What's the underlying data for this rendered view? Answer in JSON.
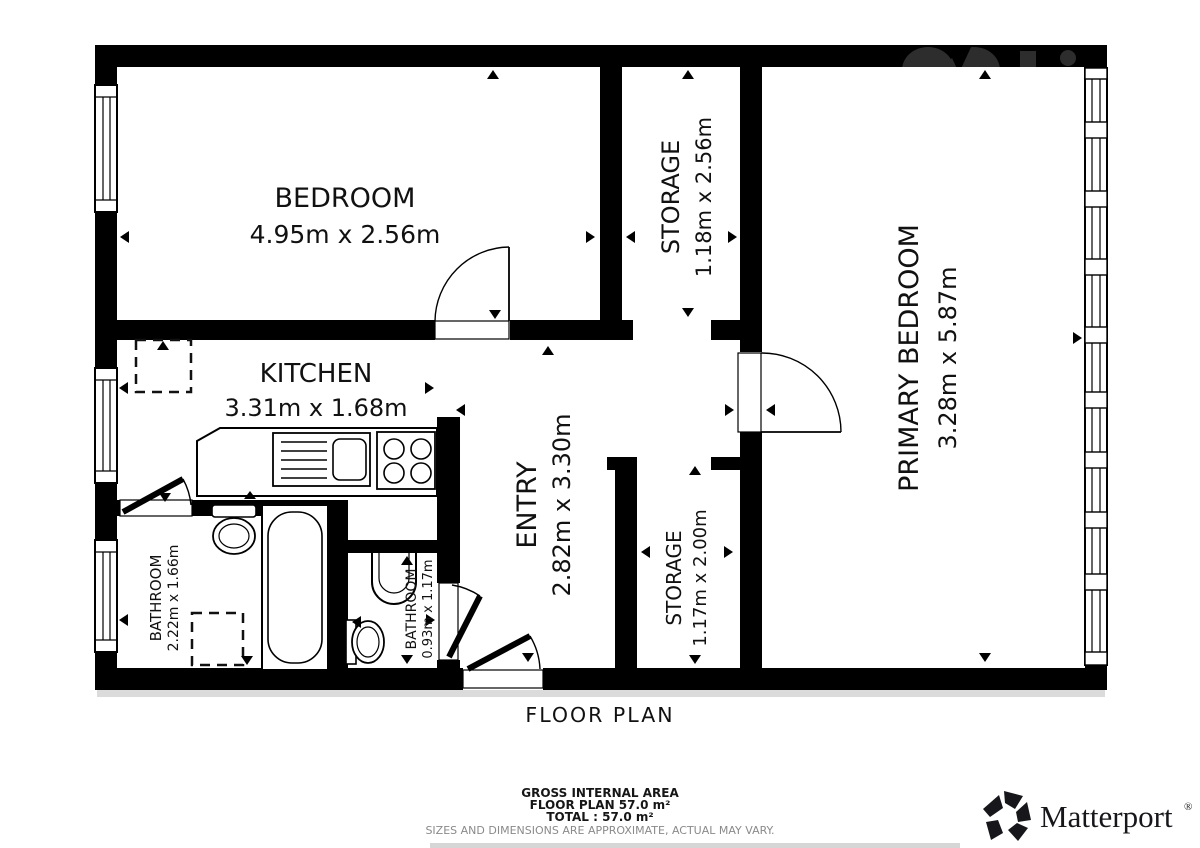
{
  "title": "FLOOR PLAN",
  "rooms": [
    {
      "name": "BEDROOM",
      "dims": "4.95m x 2.56m"
    },
    {
      "name": "STORAGE",
      "dims": "1.18m x 2.56m"
    },
    {
      "name": "PRIMARY BEDROOM",
      "dims": "3.28m x 5.87m"
    },
    {
      "name": "KITCHEN",
      "dims": "3.31m x 1.68m"
    },
    {
      "name": "ENTRY",
      "dims": "2.82m x 3.30m"
    },
    {
      "name": "STORAGE",
      "dims": "1.17m x 2.00m"
    },
    {
      "name": "BATHROOM",
      "dims": "2.22m x 1.66m"
    },
    {
      "name": "BATHROOM",
      "dims": "0.93m x 1.17m"
    }
  ],
  "footer": {
    "gross_internal_area": "GROSS INTERNAL AREA",
    "floor_plan_area": "FLOOR PLAN 57.0 m²",
    "total_area": "TOTAL :  57.0 m²",
    "disclaimer": "SIZES AND DIMENSIONS ARE APPROXIMATE, ACTUAL MAY VARY."
  },
  "brand": {
    "name": "Matterport",
    "registered": "®"
  },
  "colors": {
    "wall": "#000000",
    "text": "#111111",
    "disclaimer_gray": "#8a8a8a",
    "watermark_gray": "#2d2d2d"
  }
}
